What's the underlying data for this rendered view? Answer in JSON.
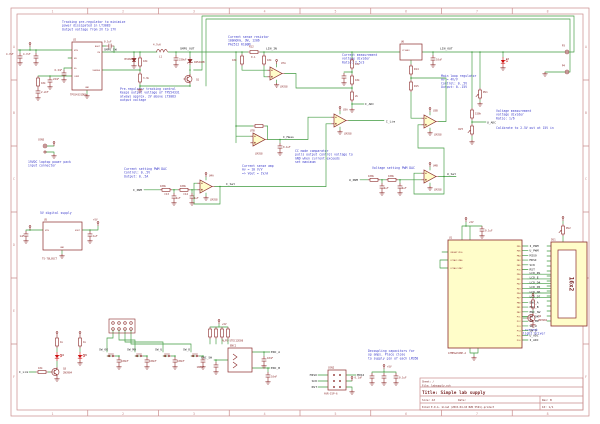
{
  "title_block": {
    "sheet": "Sheet: /",
    "file": "File: labsupply.sch",
    "title": "Title: Simple lab supply",
    "size": "Size: A3",
    "date": "Date:",
    "rev": "Rev: B",
    "tool": "KiCad E.D.A.  kicad (2015-04-10 BZR 5591)-product",
    "id": "Id: 1/1"
  },
  "frame": {
    "columns": [
      "1",
      "2",
      "3",
      "4",
      "5",
      "6",
      "7",
      "8"
    ],
    "rows": [
      "A",
      "B",
      "C",
      "D",
      "E",
      "F"
    ]
  },
  "notes": {
    "tracking": "Tracking pre-regulator to minimize\npower dissipated in LT3083\nOutput voltage from 2V to 17V",
    "sense_res": "Current sense resistor\n100mOhm, 3W, 1206\nPA2512 R100M",
    "prereg": "Pre-regulator tracking control\nKeeps output voltage of TPS54331\nalways approx. 2V above LT3083\noutput voltage",
    "cur_div": "Current measurement\nvoltage divider\nRatio: 2.5/3",
    "main_loop": "Main loop regulator\nAv = 4V/V\nControl: 0..5V\nOutput: 0..15V",
    "volt_div": "Voltage measurement\nvoltage divider\nRatio: 1/6",
    "calibrate": "Calibrate to 2.5V out at 15V in",
    "cc_comp": "CC mode comparator\npulls output control voltage to\nGND when current exceeds\nset maximum",
    "sense_amp": "Current sense amp\nAv = 10 V/V\n=> Vout = 1V/A",
    "volt_dac": "Voltage setting PWM DAC",
    "cur_dac": "Current setting PWM DAC\nControl: 0..5V\nOutput: 0..5A",
    "input_conn": "19VDC laptop power pack\ninput connector",
    "supply5": "5V digital supply",
    "decoupling": "Decoupling capacitors for\nop amps. Place close\nto supply pin of each LM358",
    "backlight": "Constant current\nLED backlight driver"
  },
  "nets": {
    "smps_sw": "SMPS_SW",
    "smps_out": "SMPS_OUT",
    "lin_in": "LIN_IN",
    "lin_out": "LIN_OUT",
    "i_meas": "I_Meas",
    "i_lim": "I_Lim",
    "i_set": "I_Set",
    "u_set": "U_Set",
    "i_pwm": "I_PWM",
    "u_pwm": "U_PWM",
    "i_adc": "I_ADC",
    "u_adc": "U_ADC",
    "enc_a": "ENC_A",
    "enc_b": "ENC_B",
    "enc_sw": "ENC_SW",
    "sw_ok": "SW_OK",
    "sw_md": "SW_MD",
    "sw_u": "SW_U",
    "sw_d": "SW_D",
    "miso": "MISO",
    "mosi": "MOSI",
    "sck": "SCK",
    "rst": "RST",
    "p5v": "+5V"
  },
  "mcu": {
    "ref": "U1",
    "value": "ATMEGA328P-A",
    "right_nets": [
      "I_PWM",
      "U_PWM",
      "MISO",
      "MOSI",
      "SCK",
      "RST",
      "LCD_RS",
      "LCD_E",
      "LCD_D4",
      "LCD_D5",
      "LCD_D6",
      "LCD_D7",
      "ENC_A",
      "ENC_B",
      "ENC_SW",
      "SW_OK",
      "SW_MD",
      "SW_U",
      "SW_D",
      "U_ADC",
      "I_ADC"
    ],
    "right_pins": [
      "PD5",
      "PD6",
      "PB4",
      "PB3",
      "PB5",
      "PC6",
      "PD0",
      "PD1",
      "PD2",
      "PD3",
      "PD4",
      "PD7",
      "PB0",
      "PB1",
      "PB2",
      "PC1",
      "PC2",
      "PC3",
      "PC4",
      "PC5",
      "PC0"
    ],
    "left_pins": [
      "(RESET)PC6",
      "(XTAL1)PB6",
      "(XTAL2)PB7"
    ]
  },
  "lcd": {
    "ref": "DS1",
    "value": "16x2"
  },
  "parts": {
    "u2": {
      "ref": "U2",
      "value": "TPS54331DDA"
    },
    "u5": {
      "ref": "U5",
      "value": "TS-78L05CT"
    },
    "u6": {
      "ref": "U6",
      "value": "LT3083"
    },
    "lm358": "LM358",
    "u7a": "U7A",
    "u7b": "U7B",
    "u3a": "U3A",
    "u3b": "U3B",
    "u4a": "U4A",
    "u4b": "U4B",
    "l1": {
      "ref": "L1",
      "value": "4.7uH"
    },
    "r12": {
      "ref": "R12",
      "value": "0.1"
    },
    "d1_val": "B340A",
    "d2_val": "1N5240B",
    "d3": "D3",
    "d4": "D4",
    "d5": "D5",
    "q1": "Q1",
    "q3": {
      "ref": "Q3",
      "value": "2N3904"
    },
    "q4": {
      "ref": "Q4",
      "value": "2N3904"
    },
    "rv1": "RV1",
    "rv2": "RV2",
    "rv3": "RV3",
    "r14": "R14",
    "r15": "R15",
    "c13": "C13",
    "c14": "C14",
    "enc": {
      "ref": "ENC1",
      "value": "ALPS-STEC12E08"
    },
    "isp": {
      "ref": "CON2",
      "value": "AVR-ISP-6"
    },
    "con5": "CON5",
    "p3": "P3",
    "p4": "P4"
  },
  "vals": {
    "c4u7": "4.7uF",
    "c220u": "220uF",
    "c10u": "10uF",
    "c1u": "1uF",
    "c0u1": "0.1uF",
    "c100n": "100nF",
    "c10n": "10nF",
    "c6n2": "6.2nF",
    "c2n2": "2.2nF",
    "c22n": "22nF",
    "r10k": "10k",
    "r100k": "100k",
    "r1k": "1k",
    "r3k3": "3.3k",
    "r2k": "2k",
    "r150k": "150k",
    "r47k": "47k"
  },
  "pins": {
    "tps": {
      "vin": "VIN",
      "en": "EN",
      "ss": "SS",
      "comp": "COMP",
      "boot": "BOOT",
      "ph": "PH",
      "vsense": "VSENSE",
      "gnd": "GND"
    },
    "reg": {
      "vin": "VIN",
      "vout": "VOUT",
      "gnd": "GND"
    }
  }
}
